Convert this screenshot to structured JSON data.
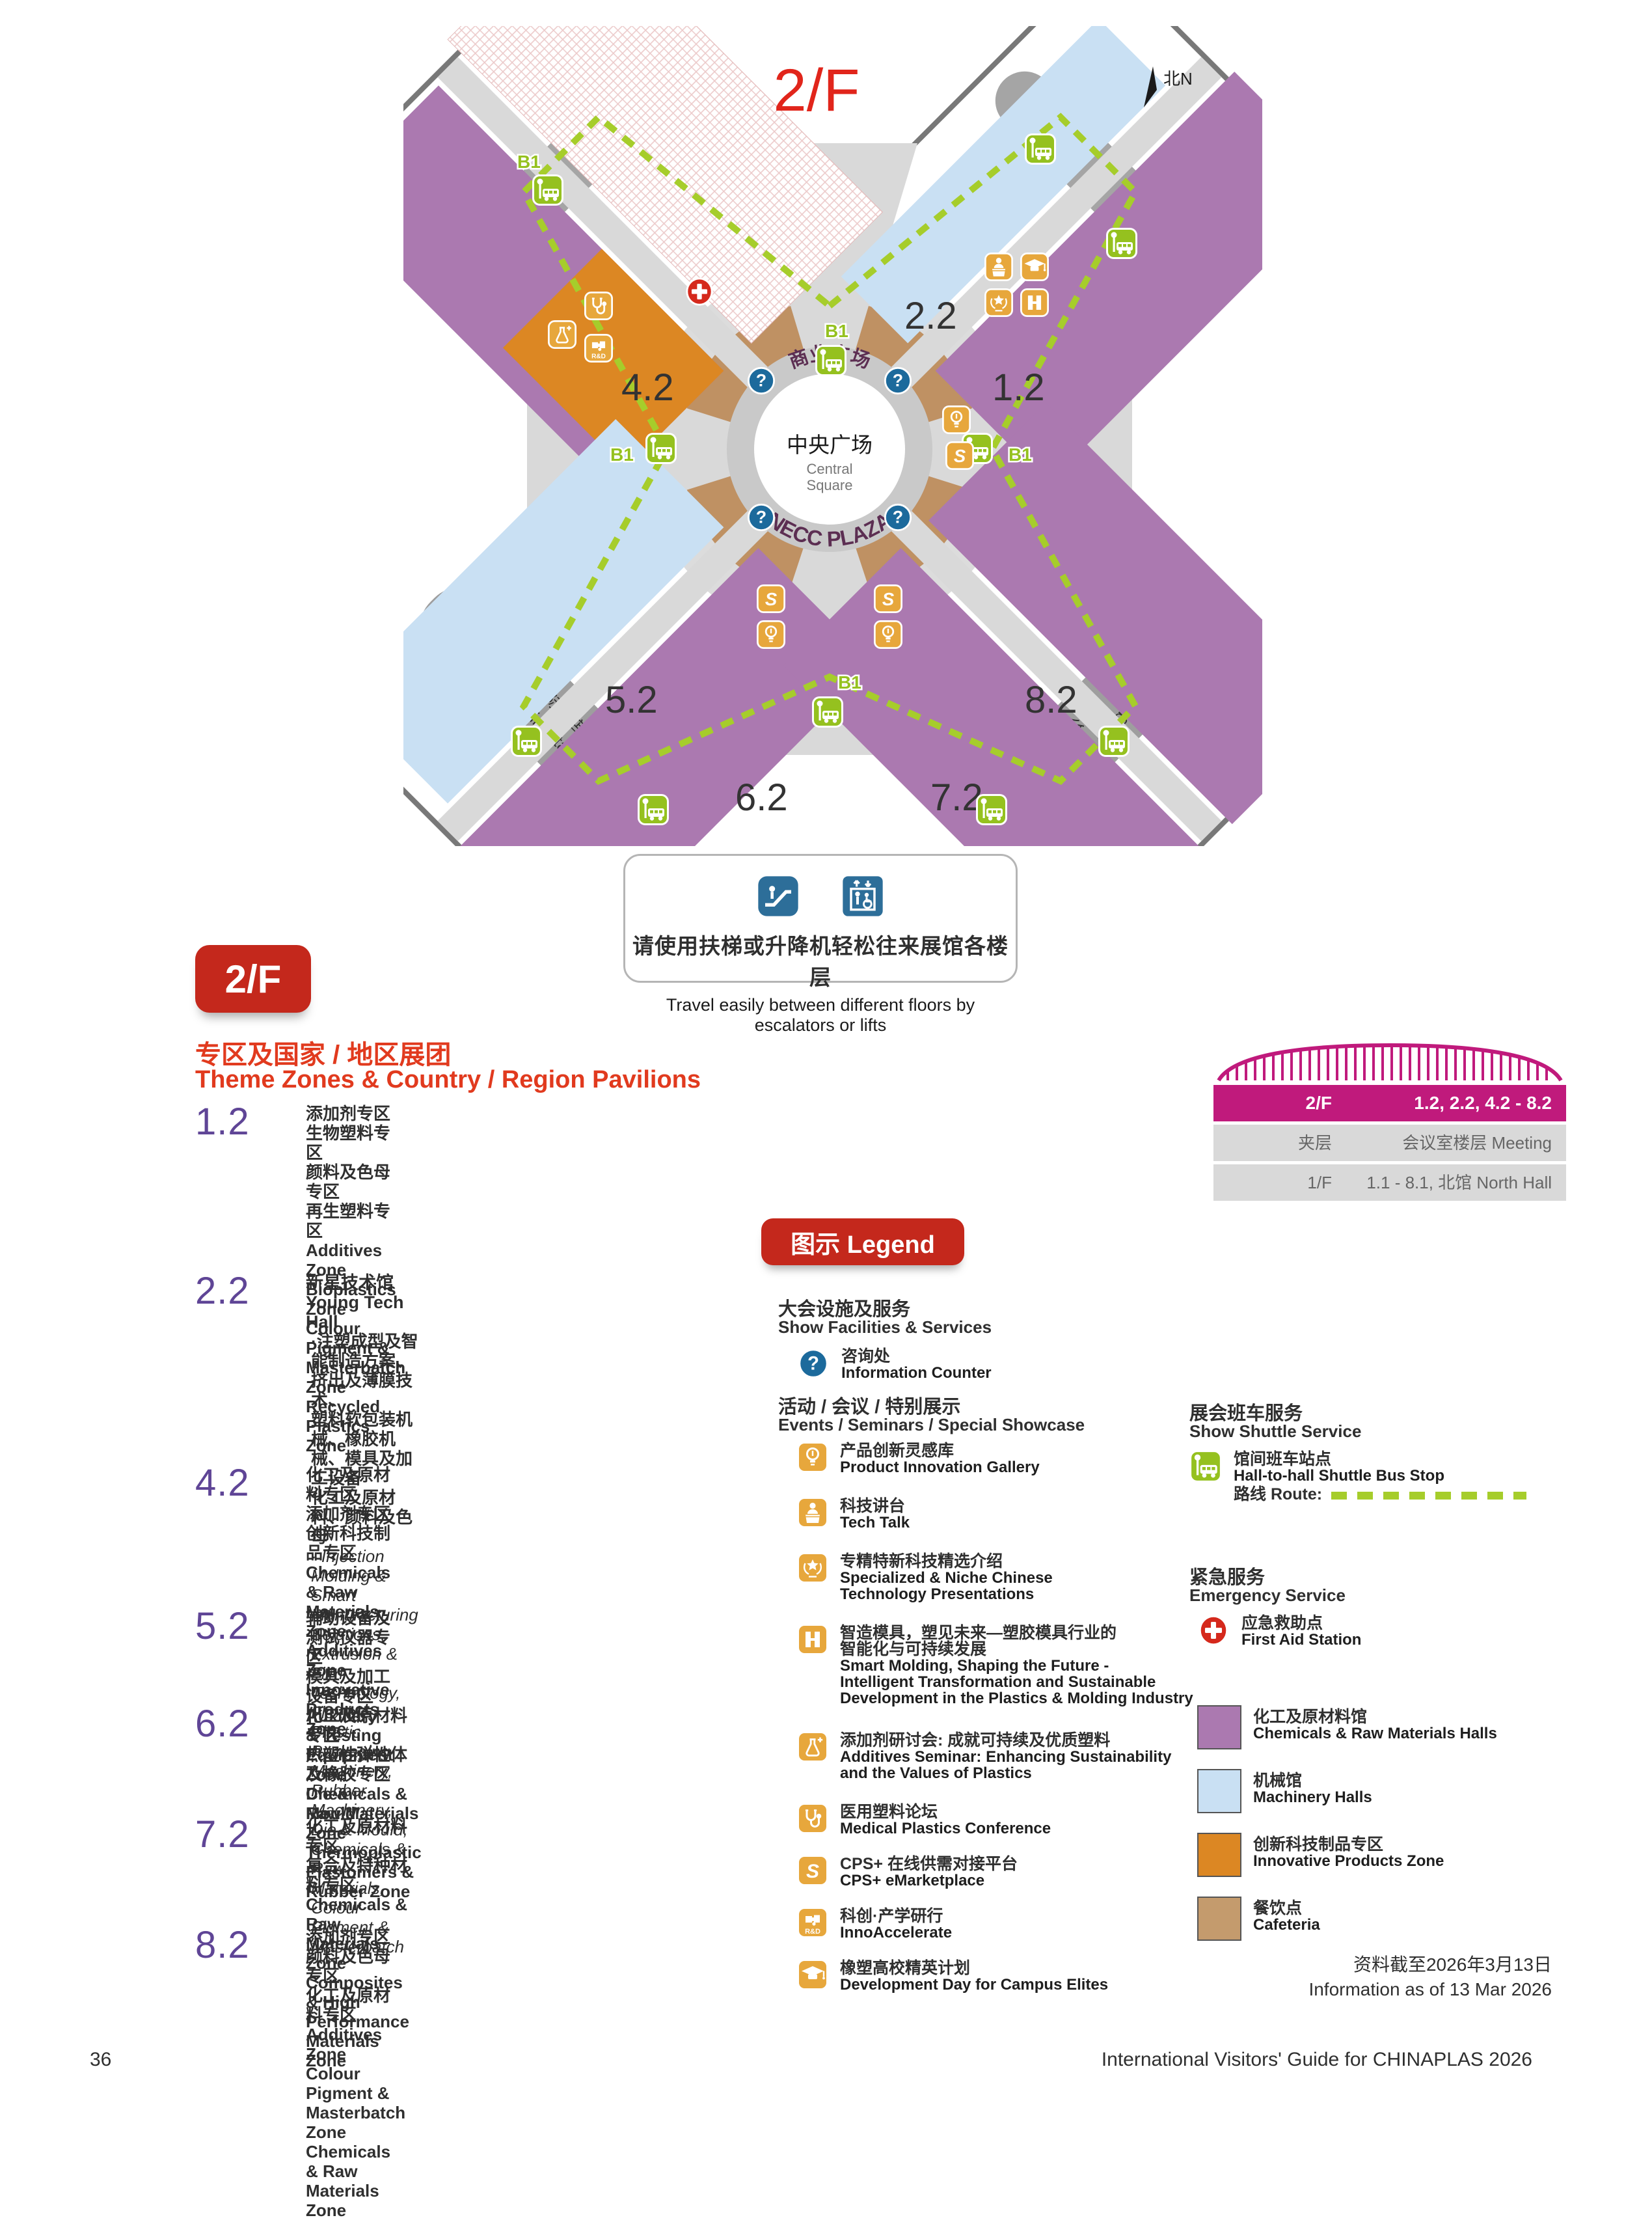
{
  "map": {
    "title": "2/F",
    "north_label": "北N",
    "b1": "B1",
    "halls": {
      "h12": "1.2",
      "h22": "2.2",
      "h42": "4.2",
      "h52": "5.2",
      "h62": "6.2",
      "h72": "7.2",
      "h82": "8.2"
    },
    "center": {
      "arc_top": "商业广场",
      "cn": "中央广场",
      "en1": "Central",
      "en2": "Square",
      "arc_bottom": "NECC PLAZA"
    },
    "hotel": {
      "cn": "洲际酒店",
      "en": "InterContinental Hotel"
    },
    "office": {
      "cn": "办公楼",
      "en": "Office Bldg",
      "letter": "C"
    }
  },
  "notice": {
    "cn": "请使用扶梯或升降机轻松往来展馆各楼层",
    "en": "Travel easily between different floors by escalators or lifts"
  },
  "floor_badge": "2/F",
  "section": {
    "title_cn": "专区及国家 / 地区展团",
    "title_en": "Theme Zones & Country / Region Pavilions"
  },
  "zones": [
    {
      "no": "1.2",
      "cn": [
        "添加剂专区",
        "生物塑料专区",
        "颜料及色母专区",
        "再生塑料专区"
      ],
      "en": [
        "Additives Zone",
        "Bioplastics Zone",
        "Colour Pigment & Masterbatch Zone",
        "Recycled Plastics Zone"
      ]
    },
    {
      "no": "2.2",
      "title": "新星技术馆  Young Tech Hall",
      "cn_bullet": [
        "·注塑成型及智能制造方案、挤出及薄膜技术、",
        "塑料软包装机械、橡胶机械、模具及加工设备",
        "化工及原材料、颜料及色母"
      ],
      "en_bullet": [
        "· Injection Molding & Smart Manufacturing Solutions,",
        "Extrusion & Film Technology,",
        "Flexible Plastic Packaging Machinery,",
        "Rubber Machinery, Die & Mould,",
        "Chemicals & Raw Materials,",
        "Colour Pigment & Masterbatch"
      ]
    },
    {
      "no": "4.2",
      "cn": [
        "化工及原材料专区",
        "添加剂专区",
        "创新科技制品专区"
      ],
      "en": [
        "Chemicals & Raw Materials Zone",
        "Additives Zone",
        "Innovative Products Zone"
      ]
    },
    {
      "no": "5.2",
      "cn": [
        "辅助设备及测试仪器专区",
        "模具及加工设备专区"
      ],
      "en": [
        "Auxiliary & Testing Equipment Zone",
        "Die & Mould Zone"
      ]
    },
    {
      "no": "6.2",
      "cn": [
        "化工及原材料专区",
        "热塑性弹性体及橡胶专区"
      ],
      "en": [
        "Chemicals & Raw Materials Zone",
        "Thermoplastic Elastomers & Rubber Zone"
      ]
    },
    {
      "no": "7.2",
      "cn": [
        "化工及原材料专区",
        "复合及特种材料专区"
      ],
      "en": [
        "Chemicals & Raw Materials Zone",
        "Composites & High Performance Materials Zone"
      ]
    },
    {
      "no": "8.2",
      "cn": [
        "添加剂专区",
        "颜料及色母专区",
        "化工及原材料专区"
      ],
      "en": [
        "Additives Zone",
        "Colour Pigment & Masterbatch Zone",
        "Chemicals & Raw Materials Zone"
      ]
    }
  ],
  "floor_table": {
    "rows": [
      {
        "left": "2/F",
        "right": "1.2, 2.2, 4.2 - 8.2"
      },
      {
        "left": "夹层 Mezzanine",
        "right": "会议室楼层 Meeting Rooms"
      },
      {
        "left": "1/F",
        "right": "1.1 - 8.1, 北馆 North Hall"
      }
    ]
  },
  "legend": {
    "badge": "图示 Legend",
    "facilities": {
      "cn": "大会设施及服务",
      "en": "Show Facilities & Services"
    },
    "info_counter": {
      "cn": "咨询处",
      "en": "Information Counter"
    },
    "events_header": {
      "cn": "活动 / 会议 / 特别展示",
      "en": "Events / Seminars / Special Showcase"
    },
    "events": [
      {
        "icon": "product-innovation-gallery",
        "cn": "产品创新灵感库",
        "en": [
          "Product Innovation Gallery"
        ]
      },
      {
        "icon": "tech-talk",
        "cn": "科技讲台",
        "en": [
          "Tech Talk"
        ]
      },
      {
        "icon": "specialized-niche",
        "cn": "专精特新科技精选介绍",
        "en": [
          "Specialized & Niche Chinese",
          "Technology Presentations"
        ]
      },
      {
        "icon": "smart-molding",
        "cn": [
          "智造模具，塑见未来—塑胶模具行业的",
          "智能化与可持续发展"
        ],
        "en": [
          "Smart Molding, Shaping the Future -",
          "Intelligent Transformation and Sustainable",
          "Development in the Plastics & Molding Industry"
        ]
      },
      {
        "icon": "additives-seminar",
        "cn": "添加剂研讨会: 成就可持续及优质塑料",
        "en": [
          "Additives Seminar: Enhancing Sustainability",
          "and the Values of Plastics"
        ]
      },
      {
        "icon": "medical-plastics",
        "cn": "医用塑料论坛",
        "en": [
          "Medical Plastics Conference"
        ]
      },
      {
        "icon": "cps-emarketplace",
        "cn": "CPS+ 在线供需对接平台",
        "en": [
          "CPS+ eMarketplace"
        ]
      },
      {
        "icon": "innoaccelerate",
        "cn": "科创·产学研行",
        "en": [
          "InnoAccelerate"
        ]
      },
      {
        "icon": "campus-elites",
        "cn": "橡塑高校精英计划",
        "en": [
          "Development Day for Campus Elites"
        ]
      }
    ],
    "shuttle": {
      "header_cn": "展会班车服务",
      "header_en": "Show Shuttle Service",
      "stop_cn": "馆间班车站点",
      "stop_en": "Hall-to-hall Shuttle Bus Stop",
      "route_label": "路线 Route:"
    },
    "emergency": {
      "header_cn": "紧急服务",
      "header_en": "Emergency Service",
      "item_cn": "应急救助点",
      "item_en": "First Aid Station"
    },
    "hall_colors": [
      {
        "color": "#ab79b0",
        "cn": "化工及原材料馆",
        "en": "Chemicals & Raw Materials Halls"
      },
      {
        "color": "#c9e0f3",
        "cn": "机械馆",
        "en": "Machinery Halls"
      },
      {
        "color": "#dc8723",
        "cn": "创新科技制品专区",
        "en": "Innovative Products Zone"
      },
      {
        "color": "#c49b6d",
        "cn": "餐饮点",
        "en": "Cafeteria"
      }
    ]
  },
  "footer": {
    "page": "36",
    "right": "International Visitors' Guide for CHINAPLAS 2026",
    "asof_cn": "资料截至2026年3月13日",
    "asof_en": "Information as of 13 Mar 2026"
  },
  "colors": {
    "accent_red": "#c4281c",
    "header_red": "#e13a1e",
    "magenta": "#c01a7c",
    "hall_purple": "#ab79b0",
    "hall_blue": "#c9e0f3",
    "orange_zone": "#dc8723",
    "cafeteria_tan": "#c49b6d",
    "route_green": "#a6cd2b",
    "icon_green": "#95c11f",
    "icon_orange": "#e7a73c",
    "info_blue": "#1c6a9c",
    "aid_red": "#d5291c"
  }
}
